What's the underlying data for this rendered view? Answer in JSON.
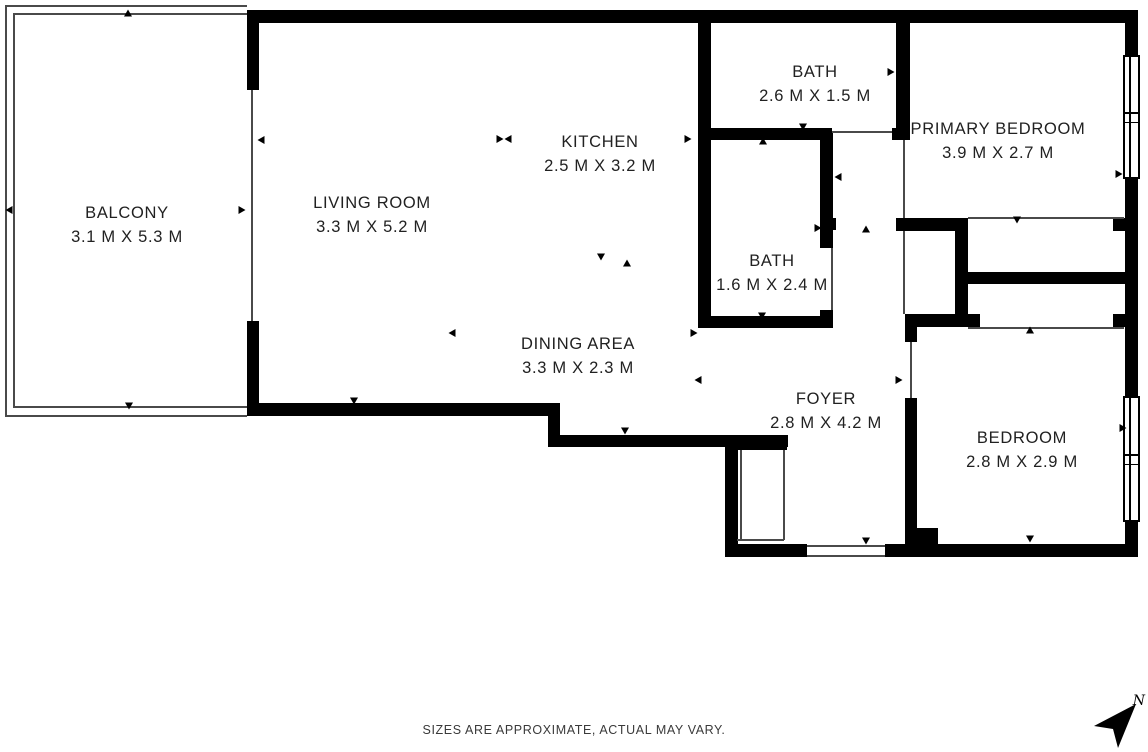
{
  "footer": {
    "disclaimer": "SIZES ARE APPROXIMATE, ACTUAL MAY VARY."
  },
  "compass": {
    "label": "N"
  },
  "colors": {
    "wall": "#000000",
    "opening_line": "#4a4a4a",
    "room_text": "#212121",
    "footer_text": "#3a3a3a",
    "background": "#ffffff"
  },
  "rooms": [
    {
      "name": "BALCONY",
      "dims": "3.1 M X 5.3 M",
      "cx": 127,
      "cy": 225
    },
    {
      "name": "LIVING ROOM",
      "dims": "3.3 M X 5.2 M",
      "cx": 372,
      "cy": 215
    },
    {
      "name": "KITCHEN",
      "dims": "2.5 M X 3.2 M",
      "cx": 600,
      "cy": 154
    },
    {
      "name": "BATH",
      "dims": "2.6 M X 1.5 M",
      "cx": 815,
      "cy": 84
    },
    {
      "name": "PRIMARY BEDROOM",
      "dims": "3.9 M X 2.7 M",
      "cx": 998,
      "cy": 141
    },
    {
      "name": "BATH",
      "dims": "1.6 M X 2.4 M",
      "cx": 772,
      "cy": 273
    },
    {
      "name": "DINING AREA",
      "dims": "3.3 M X 2.3 M",
      "cx": 578,
      "cy": 356
    },
    {
      "name": "FOYER",
      "dims": "2.8 M X 4.2 M",
      "cx": 826,
      "cy": 411
    },
    {
      "name": "BEDROOM",
      "dims": "2.8 M X 2.9 M",
      "cx": 1022,
      "cy": 450
    }
  ],
  "plan": {
    "walls": [
      [
        247,
        10,
        891,
        13
      ],
      [
        247,
        10,
        12,
        80
      ],
      [
        247,
        321,
        12,
        95
      ],
      [
        247,
        403,
        313,
        13
      ],
      [
        548,
        403,
        12,
        44
      ],
      [
        548,
        435,
        240,
        12
      ],
      [
        725,
        438,
        13,
        119
      ],
      [
        737,
        438,
        50,
        12
      ],
      [
        725,
        544,
        82,
        13
      ],
      [
        885,
        544,
        253,
        13
      ],
      [
        912,
        528,
        26,
        16
      ],
      [
        698,
        10,
        13,
        318
      ],
      [
        698,
        128,
        134,
        12
      ],
      [
        892,
        128,
        18,
        12
      ],
      [
        896,
        10,
        14,
        128
      ],
      [
        698,
        316,
        133,
        12
      ],
      [
        820,
        133,
        13,
        115
      ],
      [
        820,
        310,
        13,
        18
      ],
      [
        826,
        218,
        10,
        12
      ],
      [
        896,
        218,
        72,
        13
      ],
      [
        955,
        218,
        13,
        109
      ],
      [
        905,
        314,
        75,
        13
      ],
      [
        905,
        314,
        12,
        28
      ],
      [
        905,
        398,
        12,
        146
      ],
      [
        968,
        272,
        157,
        12
      ],
      [
        1125,
        10,
        13,
        47
      ],
      [
        1125,
        177,
        13,
        221
      ],
      [
        1125,
        520,
        13,
        37
      ],
      [
        1113,
        218,
        12,
        13
      ],
      [
        1113,
        314,
        12,
        13
      ]
    ],
    "opening_lines": [
      [
        5,
        5,
        242,
        2
      ],
      [
        5,
        5,
        2,
        412
      ],
      [
        5,
        415,
        242,
        2
      ],
      [
        13,
        13,
        234,
        2
      ],
      [
        13,
        13,
        2,
        395
      ],
      [
        13,
        406,
        234,
        2
      ],
      [
        251,
        90,
        2,
        231
      ],
      [
        832,
        131,
        60,
        2
      ],
      [
        903,
        140,
        2,
        78
      ],
      [
        903,
        231,
        2,
        83
      ],
      [
        968,
        217,
        156,
        2
      ],
      [
        968,
        327,
        156,
        2
      ],
      [
        910,
        342,
        2,
        56
      ],
      [
        831,
        248,
        2,
        62
      ],
      [
        740,
        450,
        2,
        90
      ],
      [
        783,
        450,
        2,
        90
      ],
      [
        737,
        539,
        47,
        2
      ],
      [
        807,
        545,
        78,
        2
      ],
      [
        807,
        555,
        78,
        2
      ]
    ],
    "windows": [
      {
        "x": 1123,
        "y": 55,
        "w": 17,
        "h": 124
      },
      {
        "x": 1123,
        "y": 396,
        "w": 17,
        "h": 126
      }
    ],
    "arrows": [
      {
        "x": 128,
        "y": 13,
        "dir": "up"
      },
      {
        "x": 129,
        "y": 406,
        "dir": "down"
      },
      {
        "x": 9,
        "y": 210,
        "dir": "left"
      },
      {
        "x": 242,
        "y": 210,
        "dir": "right"
      },
      {
        "x": 355,
        "y": 16,
        "dir": "up"
      },
      {
        "x": 261,
        "y": 140,
        "dir": "left"
      },
      {
        "x": 354,
        "y": 401,
        "dir": "down"
      },
      {
        "x": 452,
        "y": 333,
        "dir": "left"
      },
      {
        "x": 600,
        "y": 16,
        "dir": "up"
      },
      {
        "x": 500,
        "y": 139,
        "dir": "right"
      },
      {
        "x": 508,
        "y": 139,
        "dir": "left"
      },
      {
        "x": 688,
        "y": 139,
        "dir": "right"
      },
      {
        "x": 601,
        "y": 257,
        "dir": "down"
      },
      {
        "x": 627,
        "y": 263,
        "dir": "up"
      },
      {
        "x": 805,
        "y": 18,
        "dir": "up"
      },
      {
        "x": 705,
        "y": 72,
        "dir": "left"
      },
      {
        "x": 891,
        "y": 72,
        "dir": "right"
      },
      {
        "x": 803,
        "y": 127,
        "dir": "down"
      },
      {
        "x": 866,
        "y": 229,
        "dir": "up"
      },
      {
        "x": 838,
        "y": 177,
        "dir": "left"
      },
      {
        "x": 763,
        "y": 141,
        "dir": "up"
      },
      {
        "x": 705,
        "y": 228,
        "dir": "left"
      },
      {
        "x": 818,
        "y": 228,
        "dir": "right"
      },
      {
        "x": 762,
        "y": 316,
        "dir": "down"
      },
      {
        "x": 694,
        "y": 333,
        "dir": "right"
      },
      {
        "x": 698,
        "y": 380,
        "dir": "left"
      },
      {
        "x": 625,
        "y": 431,
        "dir": "down"
      },
      {
        "x": 866,
        "y": 541,
        "dir": "down"
      },
      {
        "x": 912,
        "y": 434,
        "dir": "up"
      },
      {
        "x": 1017,
        "y": 18,
        "dir": "up"
      },
      {
        "x": 1017,
        "y": 220,
        "dir": "down"
      },
      {
        "x": 1119,
        "y": 174,
        "dir": "right"
      },
      {
        "x": 1030,
        "y": 330,
        "dir": "up"
      },
      {
        "x": 1030,
        "y": 539,
        "dir": "down"
      },
      {
        "x": 1123,
        "y": 428,
        "dir": "right"
      },
      {
        "x": 899,
        "y": 380,
        "dir": "right"
      }
    ]
  }
}
